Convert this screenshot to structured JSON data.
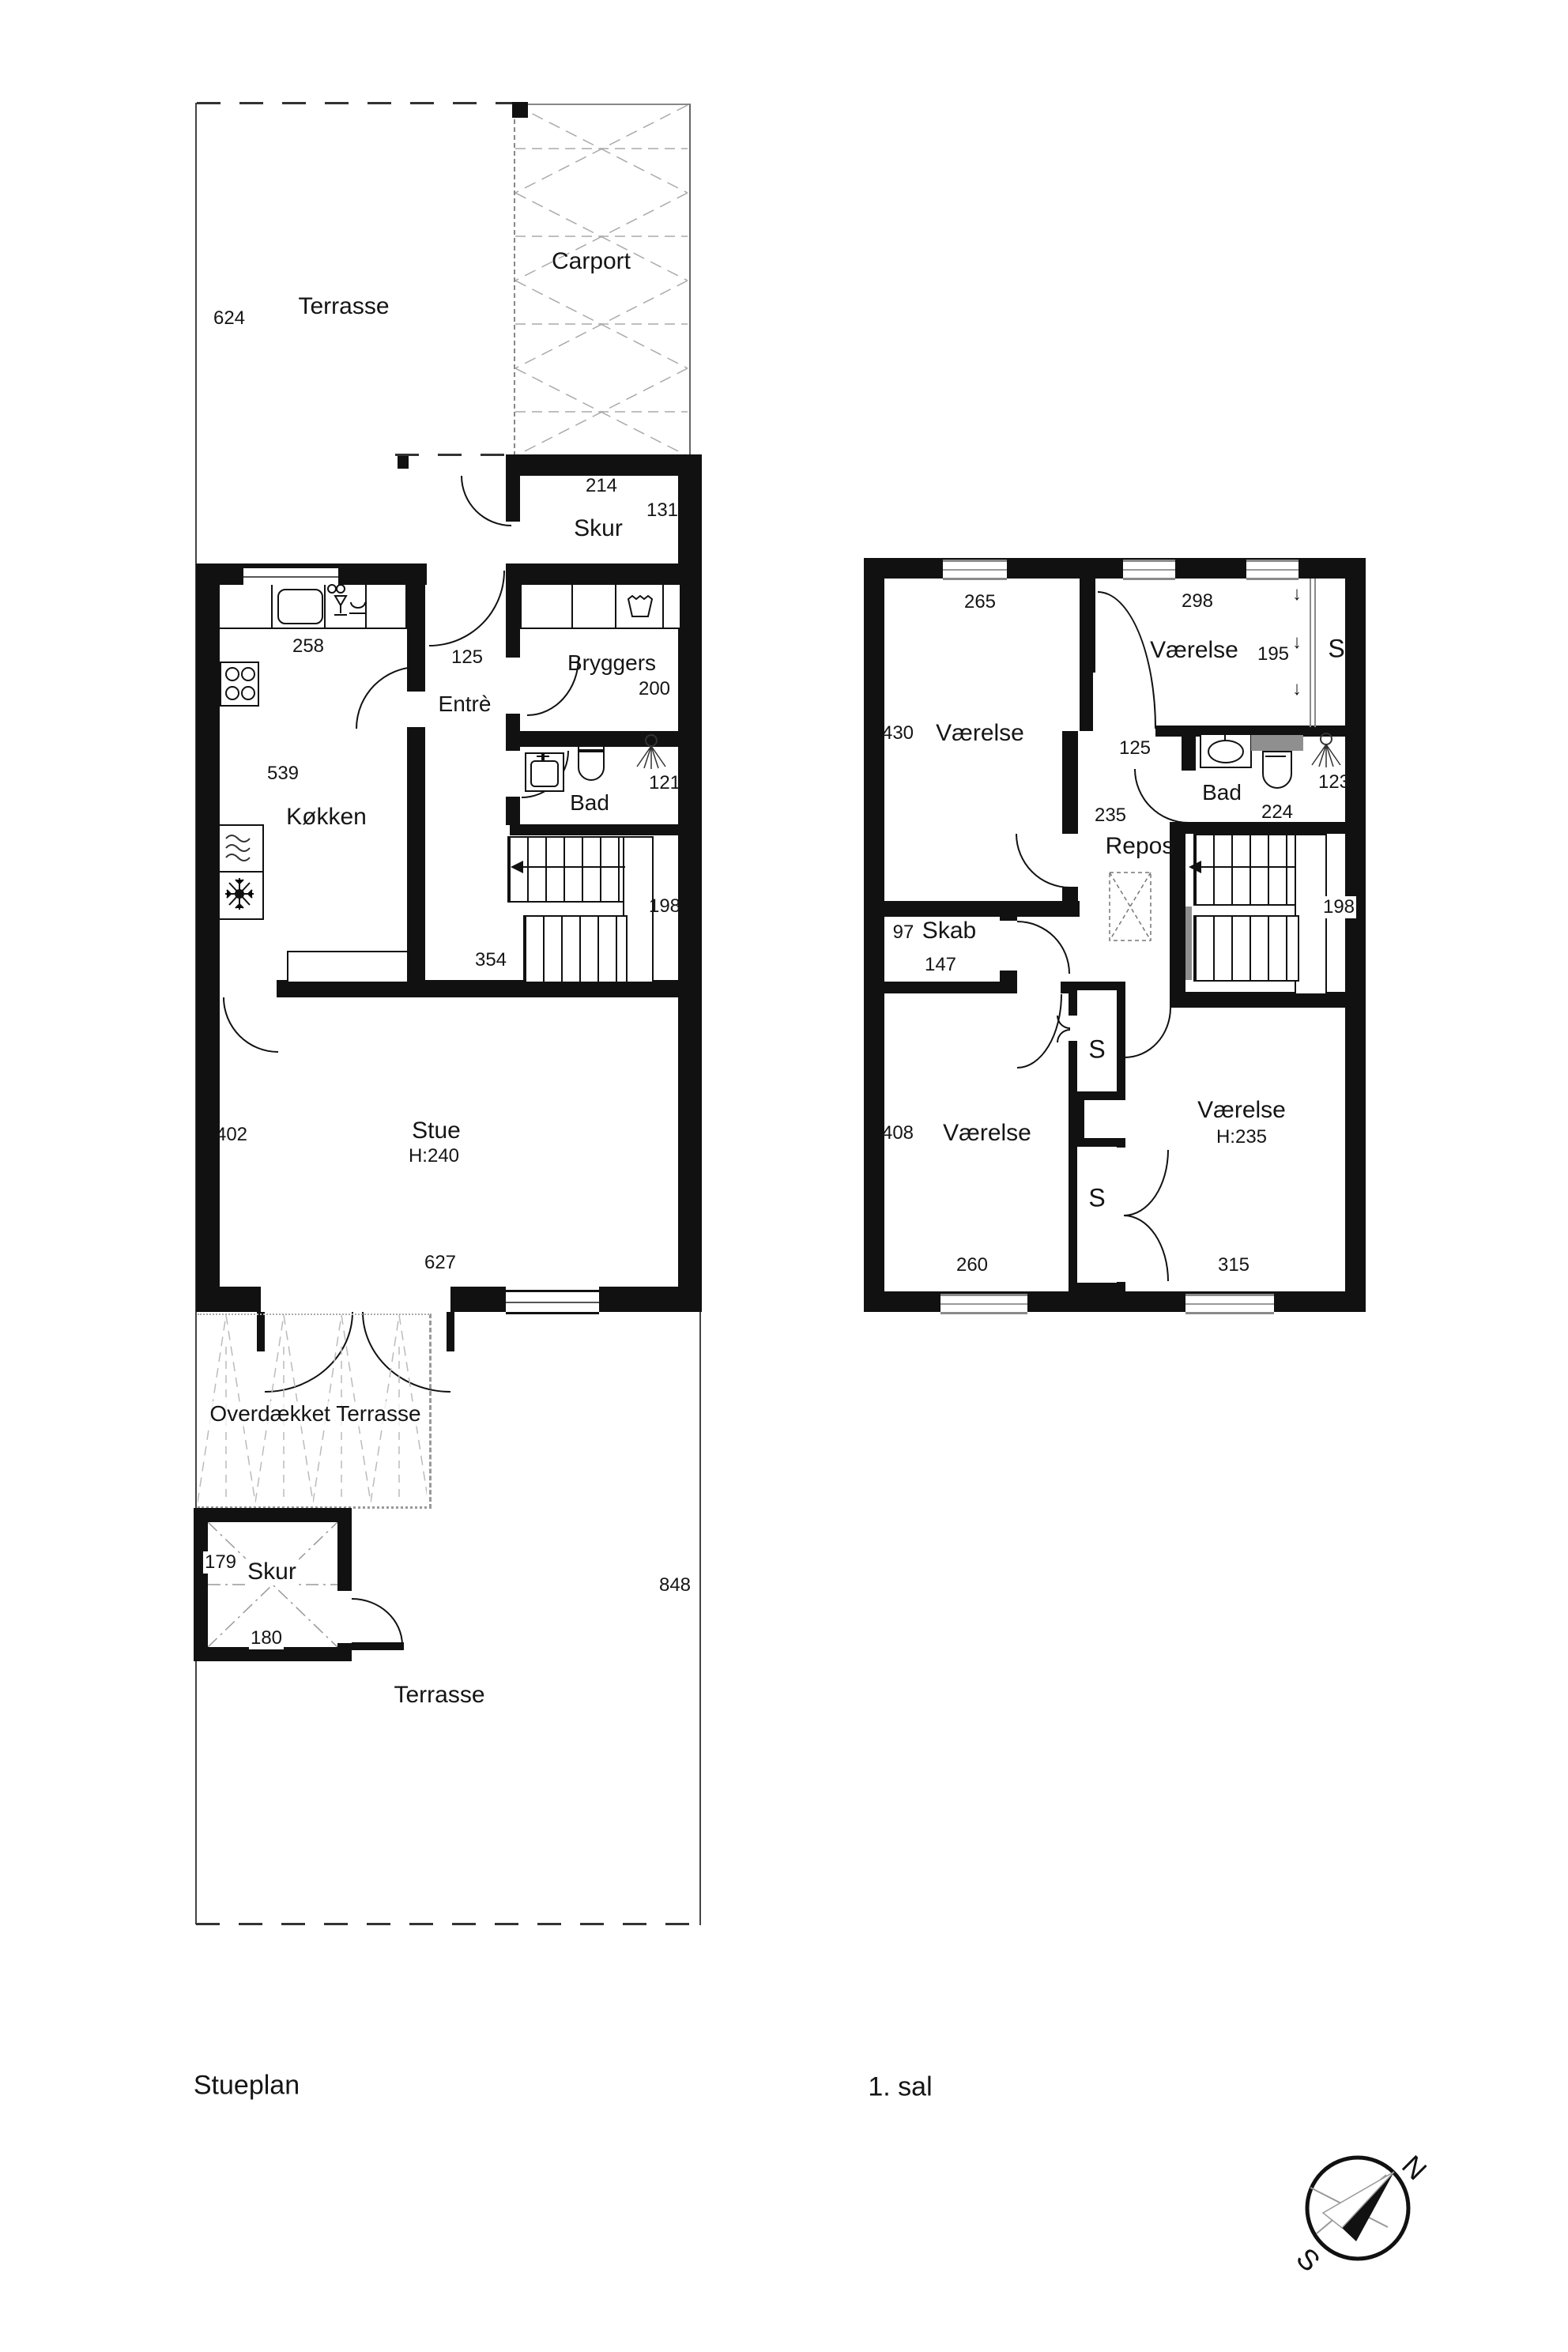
{
  "site": {
    "terrasse_top": "Terrasse",
    "dim_terrasse_height": "624",
    "carport": "Carport",
    "terrasse_bottom": "Terrasse",
    "dim_lot_right": "848"
  },
  "ground": {
    "plan_label": "Stueplan",
    "skur_top": {
      "label": "Skur",
      "dim_w": "214",
      "dim_h": "131"
    },
    "kitchen": {
      "label": "Køkken",
      "dim_h": "539",
      "dim_counter": "258"
    },
    "entre": {
      "label": "Entrè",
      "dim_w": "125"
    },
    "bryggers": {
      "label": "Bryggers",
      "dim_w": "200"
    },
    "bad": {
      "label": "Bad",
      "dim_w": "121"
    },
    "stairs": {
      "dim_w": "198"
    },
    "hall": {
      "dim_w": "354"
    },
    "stue": {
      "label": "Stue",
      "ceiling": "H:240",
      "dim_w": "627",
      "dim_h": "402"
    },
    "covered_terrace": {
      "label": "Overdækket Terrasse"
    },
    "skur_bottom": {
      "label": "Skur",
      "dim_h": "179",
      "dim_w": "180"
    }
  },
  "first": {
    "plan_label": "1. sal",
    "room_tl": {
      "label": "Værelse",
      "dim_w": "265",
      "dim_h": "430"
    },
    "room_tr": {
      "label": "Værelse",
      "dim_w": "298",
      "dim_h": "195"
    },
    "closet_tr": {
      "label": "S"
    },
    "passage": {
      "dim_w": "125"
    },
    "bad": {
      "label": "Bad",
      "dim_w": "224",
      "dim_h": "123"
    },
    "repos": {
      "label": "Repos",
      "dim_w": "235"
    },
    "skab": {
      "label": "Skab",
      "dim_h": "97",
      "dim_w": "147"
    },
    "stairs": {
      "dim_w": "198"
    },
    "closet_mid_upper": {
      "label": "S"
    },
    "closet_mid_lower": {
      "label": "S"
    },
    "room_bl": {
      "label": "Værelse",
      "dim_h": "408",
      "dim_w": "260"
    },
    "room_br": {
      "label": "Værelse",
      "ceiling": "H:235",
      "dim_w": "315"
    }
  },
  "icons": {
    "slope_arrow": "↓"
  },
  "compass": {
    "north": "N",
    "south": "S"
  }
}
